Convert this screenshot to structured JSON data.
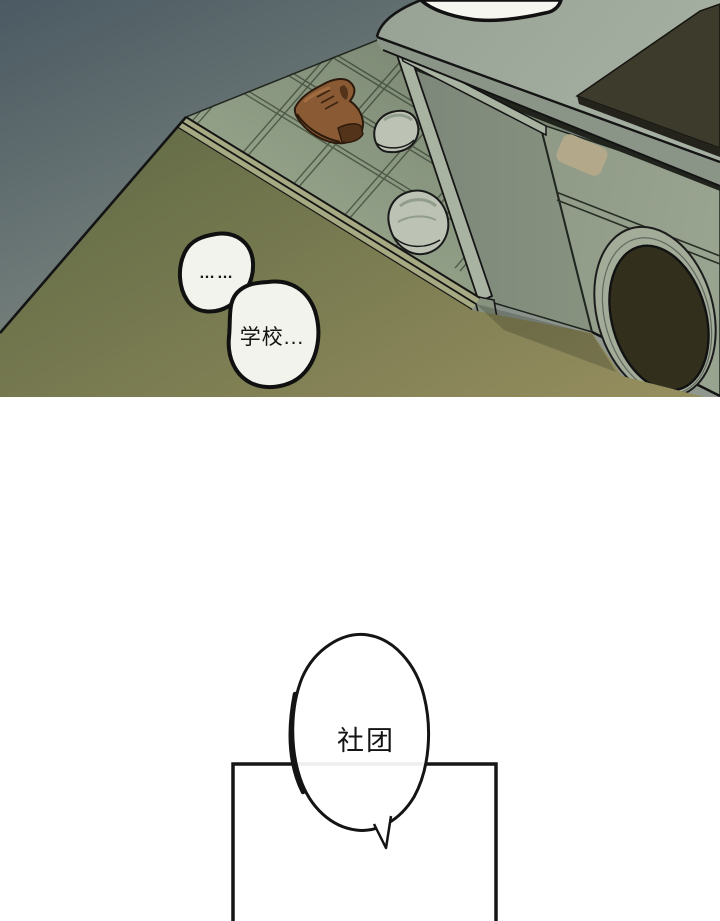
{
  "panel1": {
    "bubbles": [
      {
        "text": "……"
      },
      {
        "text": "学校..."
      }
    ]
  },
  "panel2": {
    "bubble": {
      "text": "社团"
    }
  },
  "palette": {
    "paper": "#ffffff",
    "ink": "#141414",
    "wall-dark": "#4b5a63",
    "wall-mid": "#75807b",
    "wall-light": "#8f978e",
    "floor-dark": "#636c46",
    "floor-light": "#948d5e",
    "tile": "#93a088",
    "tile-line": "#46523f",
    "trim-strip": "#a6a981",
    "counter-top": "#98a294",
    "counter-light": "#a6b0a2",
    "counter-edge": "#8b9587",
    "slot-dark": "#20241d",
    "panel-side": "#87927f",
    "panel-side-dark": "#7c877a",
    "leg-highlight": "#a9b3a2",
    "washer-front": "#8f9a86",
    "washer-light": "#99a490",
    "washer-ring": "#a2ac99",
    "washer-door": "#322f1d",
    "washer-label": "#b3a98a",
    "cooktop": "#3d3b2c",
    "cooktop-edge": "#24231b",
    "shoe-brown": "#8a5a34",
    "shoe-light": "#a06c40",
    "shoe-dark": "#53331a",
    "sneaker": "#bcc3b5",
    "sneaker-shade": "#929d8c",
    "bubble-fill": "#f3f3ee",
    "white-object": "#f6f6f1"
  }
}
